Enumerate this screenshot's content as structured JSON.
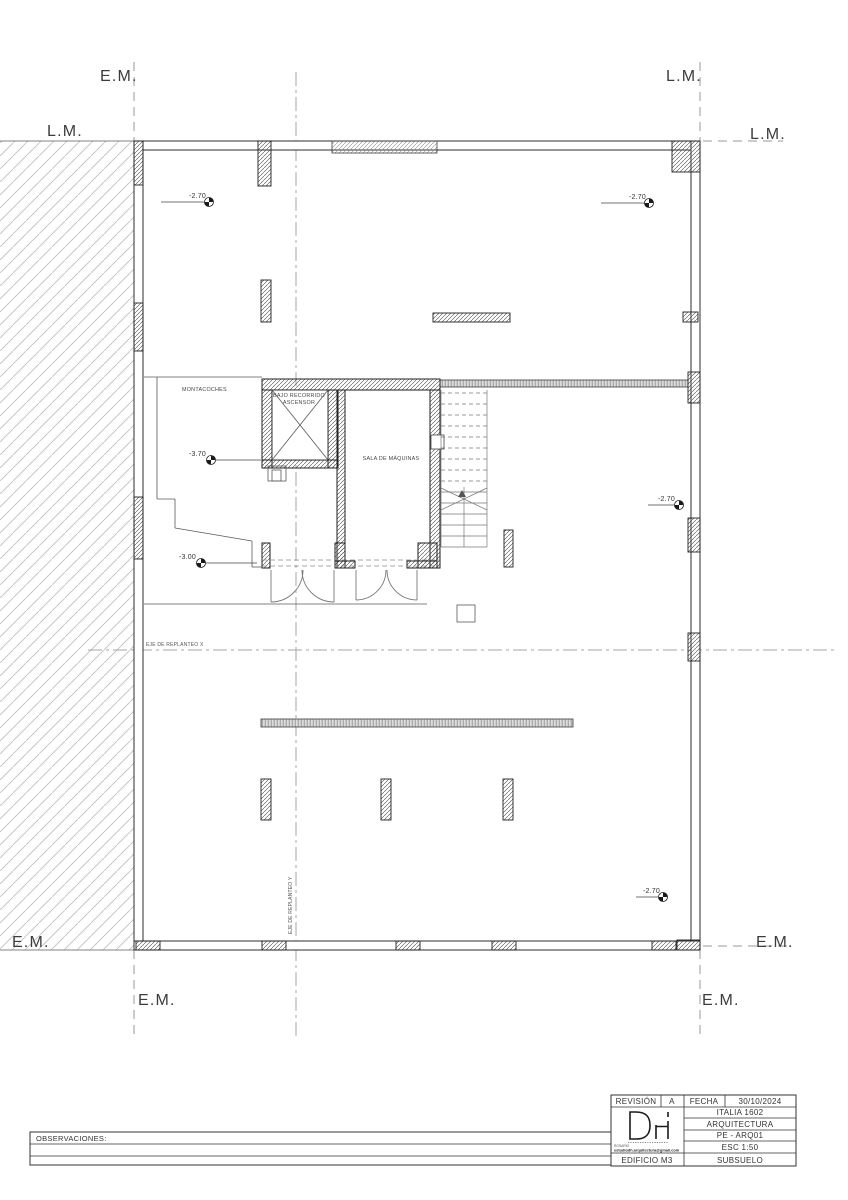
{
  "colors": {
    "line": "#2d2d2d",
    "hatch": "#bdbdbd",
    "axis": "#9a9a9a",
    "text": "#3a3a3a"
  },
  "plan": {
    "boundary_labels": {
      "top_left_axis": "E.M.",
      "top_left_line": "L.M.",
      "top_right_axis": "L.M.",
      "top_right_line": "L.M.",
      "bottom_left_line": "E.M.",
      "bottom_right_line": "E.M.",
      "bottom_left_axis": "E.M.",
      "bottom_right_axis": "E.M."
    },
    "setout_axes": {
      "x_label": "EJE DE REPLANTEO X",
      "y_label": "EJE DE REPLANTEO Y"
    },
    "room_labels": {
      "montacoches": "MONTACOCHES",
      "elevator_pit_line1": "BAJO RECORRIDO",
      "elevator_pit_line2": "ASCENSOR",
      "machine_room": "SALA DE MÁQUINAS"
    },
    "level_markers": {
      "top_left": "-2.70",
      "top_right": "-2.70",
      "montacoches_upper": "-3.70",
      "montacoches_lower": "-3.00",
      "mid_right": "-2.70",
      "bottom_right": "-2.70"
    }
  },
  "observaciones": {
    "label": "OBSERVACIONES:"
  },
  "title_block": {
    "revision_label": "REVISIÓN",
    "revision_value": "A",
    "date_label": "FECHA",
    "date_value": "30/10/2024",
    "logo_text": "DH",
    "studio_city": "ROSARIO",
    "studio_email": "estudiodh.arquitectura@gmail.com",
    "project": "ITALIA 1602",
    "discipline": "ARQUITECTURA",
    "sheet_code": "PE - ARQ01",
    "scale": "ESC 1:50",
    "building": "EDIFICIO M3",
    "sheet_name": "SUBSUELO"
  }
}
